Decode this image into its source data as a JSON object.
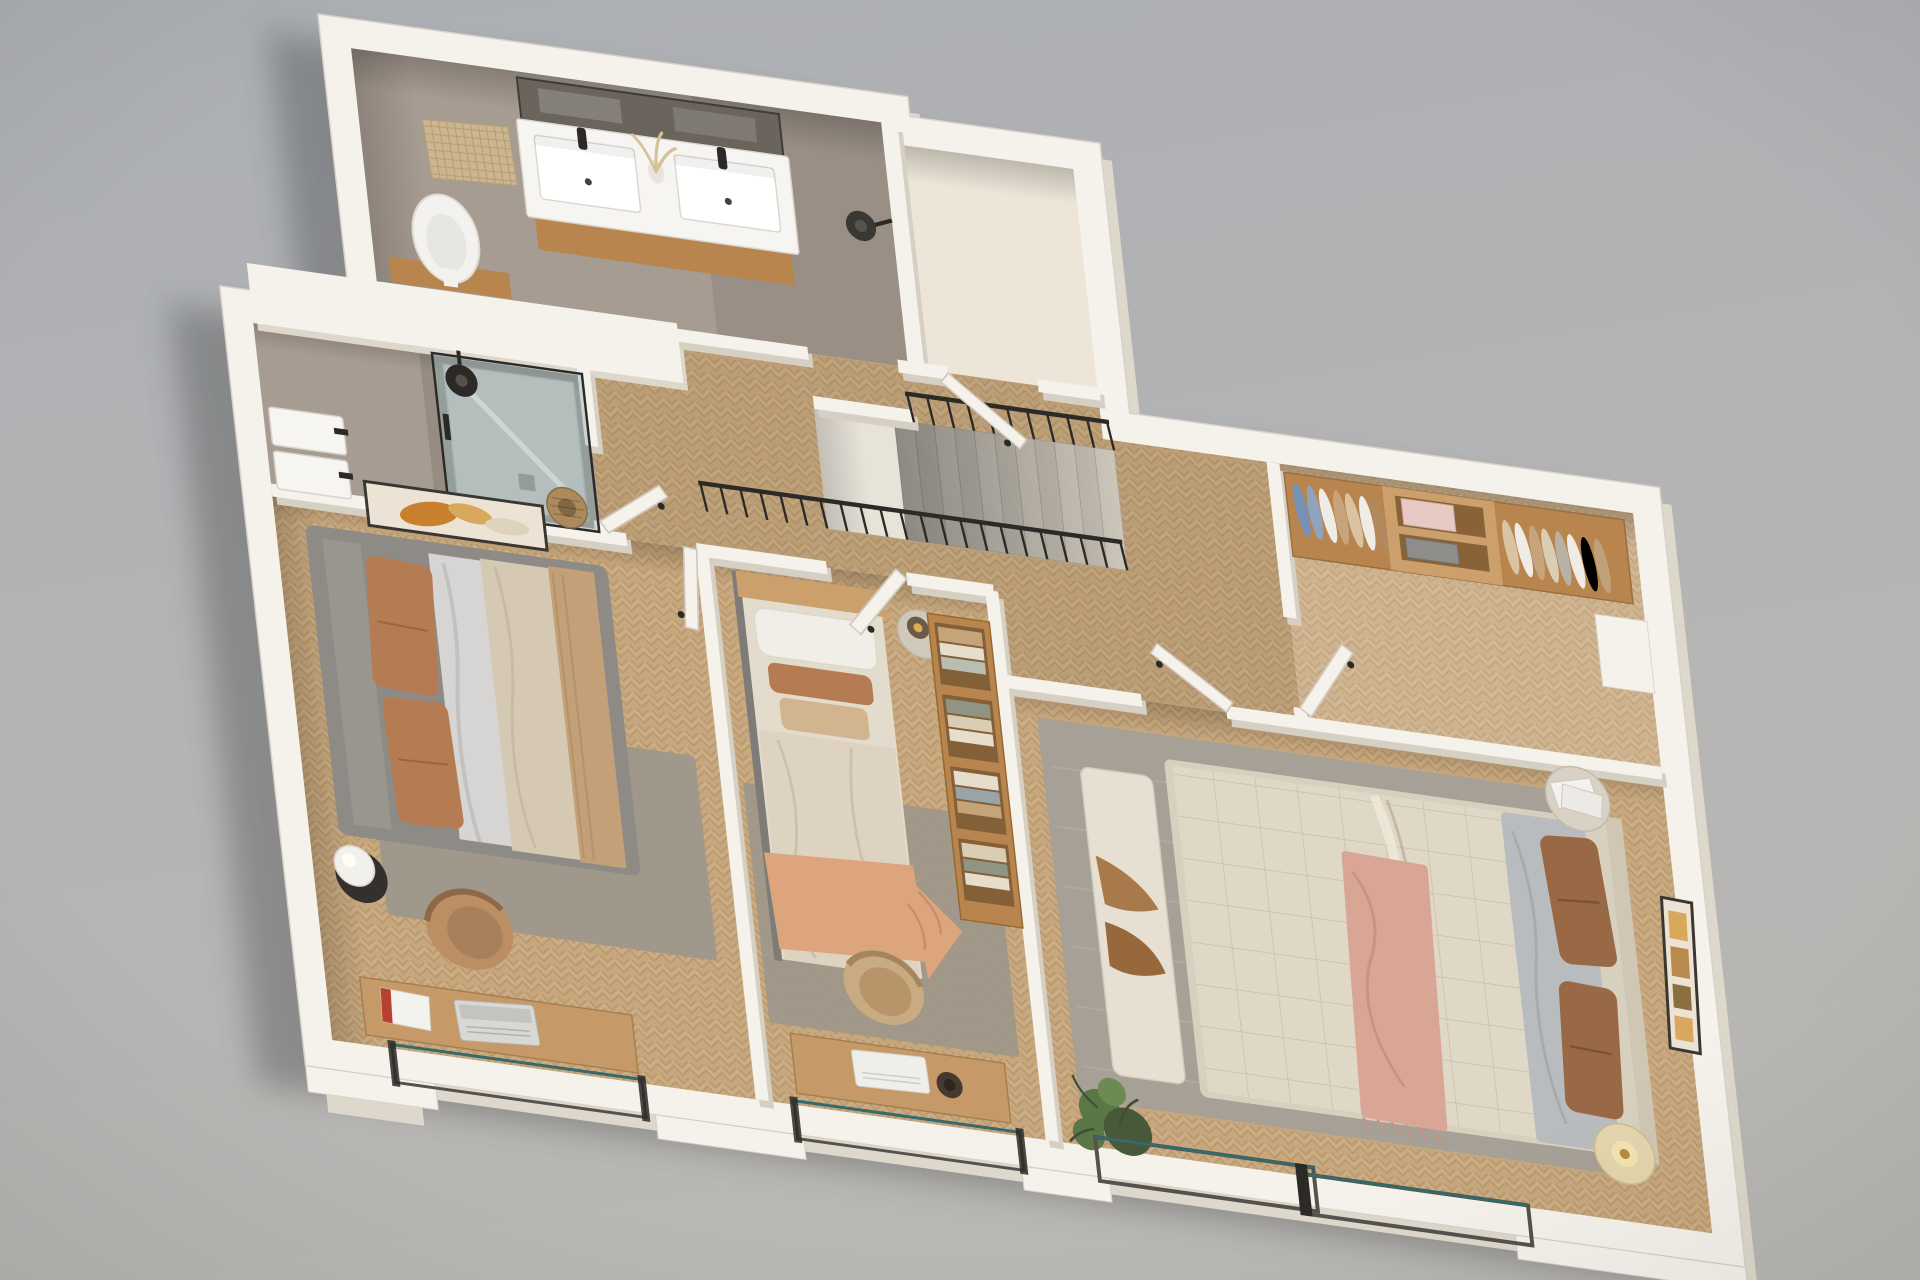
{
  "scene": {
    "description": "Axonometric 3D render of an upper-floor apartment plan with three bedrooms, two bathrooms, a WC, a walk-in wardrobe and a central staircase, furnished, on a plain gray backdrop",
    "projection": "top-down axonometric, plan rotated ~8 degrees clockwise",
    "colors": {
      "bgTop": "#aeb1b5",
      "bgBottom": "#b8b6b3",
      "shadow": "#3a3c3e",
      "wall": "#f5f2ec",
      "wallLow": "#ded8cc",
      "wallShade": "#d6cfc3",
      "outlineEdge": "#d8d2c8",
      "bathFloor": "#a79c91",
      "bathFloorDark": "#8f857a",
      "creamFloor": "#ece5d8",
      "woodBase": "#c7a77d",
      "woodDark": "#a3845c",
      "woodLight": "#d8bf97",
      "closetWood": "#b8854e",
      "closetWoodLight": "#cba06c",
      "metal": "#2c2a27",
      "frameDark": "#55524d",
      "glassFill": "rgba(150,180,184,0.45)",
      "glassEdge": "#2f6d70",
      "basinWhite": "#f7f5f1",
      "mirror": "#6a645c",
      "rugGray": "#9d978c",
      "rugGray2": "#a6a096",
      "bedGray": "#8e8b86",
      "terracotta": "#b57b52",
      "beigeDuvet": "#d5c9b4",
      "cream": "#e0d8c7",
      "tanBlanket": "#c3a077",
      "sheetGray": "#b9bcbf",
      "peach": "#dda57e",
      "brownPillow": "#996845",
      "pinkThrow": "#d9a695",
      "benchCream": "#e7dfd1",
      "blanketBrown": "#a87a4b",
      "lampBeige": "#e5d5ae",
      "sphereWhite": "#f2f0ea",
      "chairTan": "#bb8f63",
      "deskWood": "#c59a68",
      "laptopSilver": "#d8d8d5",
      "plantGreen": "#5c7747",
      "plantDark": "#47593a",
      "wicker": "#ad8a5d",
      "pinkStack": "#e7cac3",
      "basketGray": "#8e8d89",
      "artBg": "#ece3d4",
      "artOrange": "#c8802f",
      "artAmber": "#d8a85c",
      "artFrame": "#3a3733"
    }
  },
  "rooms": [
    {
      "id": "bathroom-main",
      "name": "bathroom with double vanity",
      "floor": "taupe-microcement",
      "items": [
        "double-vanity",
        "vanity-mirror",
        "twin-washbasins",
        "black-faucets",
        "dried-grass-decor",
        "woven-bath-mat",
        "toilet",
        "black-wall-lamp"
      ]
    },
    {
      "id": "wc-room",
      "name": "small WC room",
      "floor": "cream",
      "items": [
        "door"
      ]
    },
    {
      "id": "shower-bathroom",
      "name": "shower bathroom",
      "floor": "taupe-microcement",
      "items": [
        "walk-in-glass-shower",
        "rain-shower-head",
        "shower-tray",
        "twin-countertop-basins",
        "laundry-basket",
        "door"
      ]
    },
    {
      "id": "hallway",
      "name": "hallway with stairwell",
      "floor": "herringbone-oak",
      "items": [
        "staircase",
        "long-stair-railing",
        "short-stair-railing"
      ]
    },
    {
      "id": "walk-in-wardrobe",
      "name": "walk-in wardrobe",
      "floor": "herringbone-oak",
      "items": [
        "wardrobe-units",
        "hanging-clothes",
        "open-shelves",
        "folded-pink-towels",
        "gray-storage-basket",
        "door"
      ]
    },
    {
      "id": "bedroom-left",
      "name": "bedroom with gray double bed",
      "floor": "herringbone-oak",
      "items": [
        "gray-upholstered-bed",
        "terracotta-pillows",
        "beige-duvet",
        "area-rug",
        "black-side-table",
        "sphere-table-lamp",
        "tan-armchair",
        "desk",
        "laptop",
        "magazine",
        "abstract-wall-art",
        "door",
        "glass-balustrade-window"
      ]
    },
    {
      "id": "bedroom-middle",
      "name": "bedroom with single bed",
      "floor": "herringbone-oak",
      "items": [
        "single-bed",
        "white-pillow",
        "terracotta-lumbar-pillow",
        "beige-pillow",
        "peach-throw",
        "round-bedside-table",
        "amber-glass-lamp",
        "open-shelf-unit",
        "folded-clothes",
        "area-rug",
        "desk",
        "white-laptop",
        "dark-bowl",
        "tan-desk-chair",
        "door",
        "glass-balustrade-window"
      ]
    },
    {
      "id": "bedroom-master",
      "name": "master bedroom",
      "floor": "herringbone-oak",
      "items": [
        "double-bed",
        "quilted-cream-duvet",
        "gray-sheet",
        "brown-pillows",
        "pink-fringed-throw",
        "foot-bench",
        "brown-blanket",
        "large-area-rug",
        "round-side-table",
        "magazines",
        "floor-lamp",
        "potted-plant",
        "framed-wall-art",
        "door",
        "sliding-glass-door"
      ]
    }
  ],
  "exterior": {
    "items": [
      "white-plinth-walls",
      "stepped-plinth-corners",
      "glass-balustrade-left",
      "glass-balustrade-middle",
      "sliding-glass-right",
      "soft-building-shadow"
    ]
  }
}
